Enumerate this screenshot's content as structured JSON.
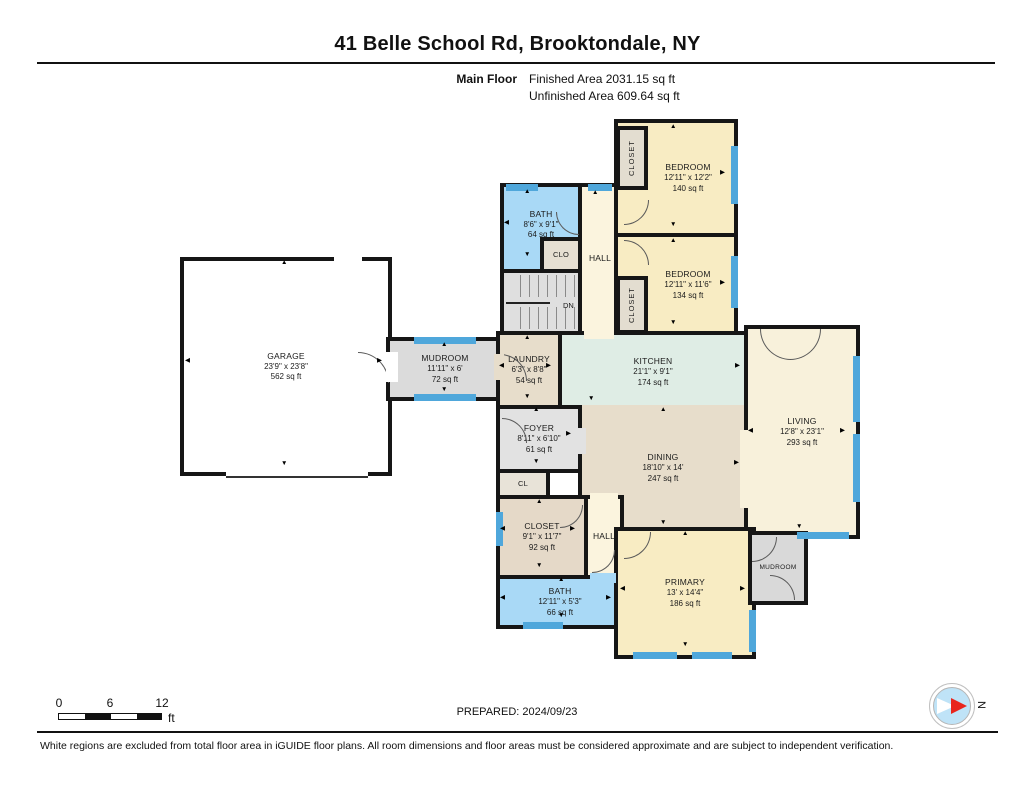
{
  "header": {
    "title": "41 Belle School Rd, Brooktondale, NY",
    "floor_label": "Main Floor",
    "finished_area": "Finished Area 2031.15 sq ft",
    "unfinished_area": "Unfinished Area 609.64 sq ft"
  },
  "colors": {
    "wall": "#161616",
    "window": "#4FA7DB",
    "bath": "#A9D9F6",
    "bedroom": "#F8ECC3",
    "living": "#F8F1DB",
    "hall": "#FBF4DE",
    "kitchen": "#DFEDE5",
    "dining": "#E7DDCB",
    "gray": "#DBDBDB",
    "closet": "#E5D9C8"
  },
  "rooms": {
    "garage": {
      "name": "GARAGE",
      "dims": "23'9\" x 23'8\"",
      "area": "562 sq ft",
      "fill": "#FFFFFF"
    },
    "mudroom": {
      "name": "MUDROOM",
      "dims": "11'11\" x 6'",
      "area": "72 sq ft",
      "fill": "#DBDBDB"
    },
    "bath_upper": {
      "name": "BATH",
      "dims": "8'6\" x 9'1\"",
      "area": "64 sq ft",
      "fill": "#A9D9F6"
    },
    "clo": {
      "name": "CLO",
      "fill": "#E6DFD2"
    },
    "hall_upper": {
      "name": "HALL",
      "fill": "#FBF4DE"
    },
    "stairs": {
      "name": "DN",
      "fill": "#DFDFDF"
    },
    "bedroom_top": {
      "name": "BEDROOM",
      "dims": "12'11\" x 12'2\"",
      "area": "140 sq ft",
      "fill": "#F8ECC3"
    },
    "closet_top": {
      "name": "CLOSET",
      "fill": "#E3DDD0"
    },
    "bedroom_mid": {
      "name": "BEDROOM",
      "dims": "12'11\" x 11'6\"",
      "area": "134 sq ft",
      "fill": "#F8ECC3"
    },
    "closet_mid": {
      "name": "CLOSET",
      "fill": "#E3DDD0"
    },
    "laundry": {
      "name": "LAUNDRY",
      "dims": "6'3\" x 8'8\"",
      "area": "54 sq ft",
      "fill": "#E7DDCB"
    },
    "kitchen": {
      "name": "KITCHEN",
      "dims": "21'1\" x 9'1\"",
      "area": "174 sq ft",
      "fill": "#DFEDE5"
    },
    "living": {
      "name": "LIVING",
      "dims": "12'8\" x 23'1\"",
      "area": "293 sq ft",
      "fill": "#F8F1DB"
    },
    "dining": {
      "name": "DINING",
      "dims": "18'10\" x 14'",
      "area": "247 sq ft",
      "fill": "#E7DDCB"
    },
    "foyer": {
      "name": "FOYER",
      "dims": "8'11\" x 6'10\"",
      "area": "61 sq ft",
      "fill": "#E2E2E2"
    },
    "cl": {
      "name": "CL",
      "fill": "#E8E3D8"
    },
    "closet_main": {
      "name": "CLOSET",
      "dims": "9'1\" x 11'7\"",
      "area": "92 sq ft",
      "fill": "#E5D9C8"
    },
    "hall_lower": {
      "name": "HALL",
      "fill": "#FBF4DE"
    },
    "bath_lower": {
      "name": "BATH",
      "dims": "12'11\" x 5'3\"",
      "area": "66 sq ft",
      "fill": "#A9D9F6"
    },
    "primary": {
      "name": "PRIMARY",
      "dims": "13' x 14'4\"",
      "area": "186 sq ft",
      "fill": "#F8ECC3"
    },
    "mudroom_small": {
      "name": "MUDROOM",
      "fill": "#D9D9D9"
    }
  },
  "scale_bar": {
    "tick0": "0",
    "tick1": "6",
    "tick2": "12",
    "unit": "ft"
  },
  "footer": {
    "prepared": "PREPARED: 2024/09/23",
    "disclaimer": "White regions are excluded from total floor area in iGUIDE floor plans. All room dimensions and floor areas must be considered approximate and are subject to independent verification.",
    "compass_label": "N"
  }
}
